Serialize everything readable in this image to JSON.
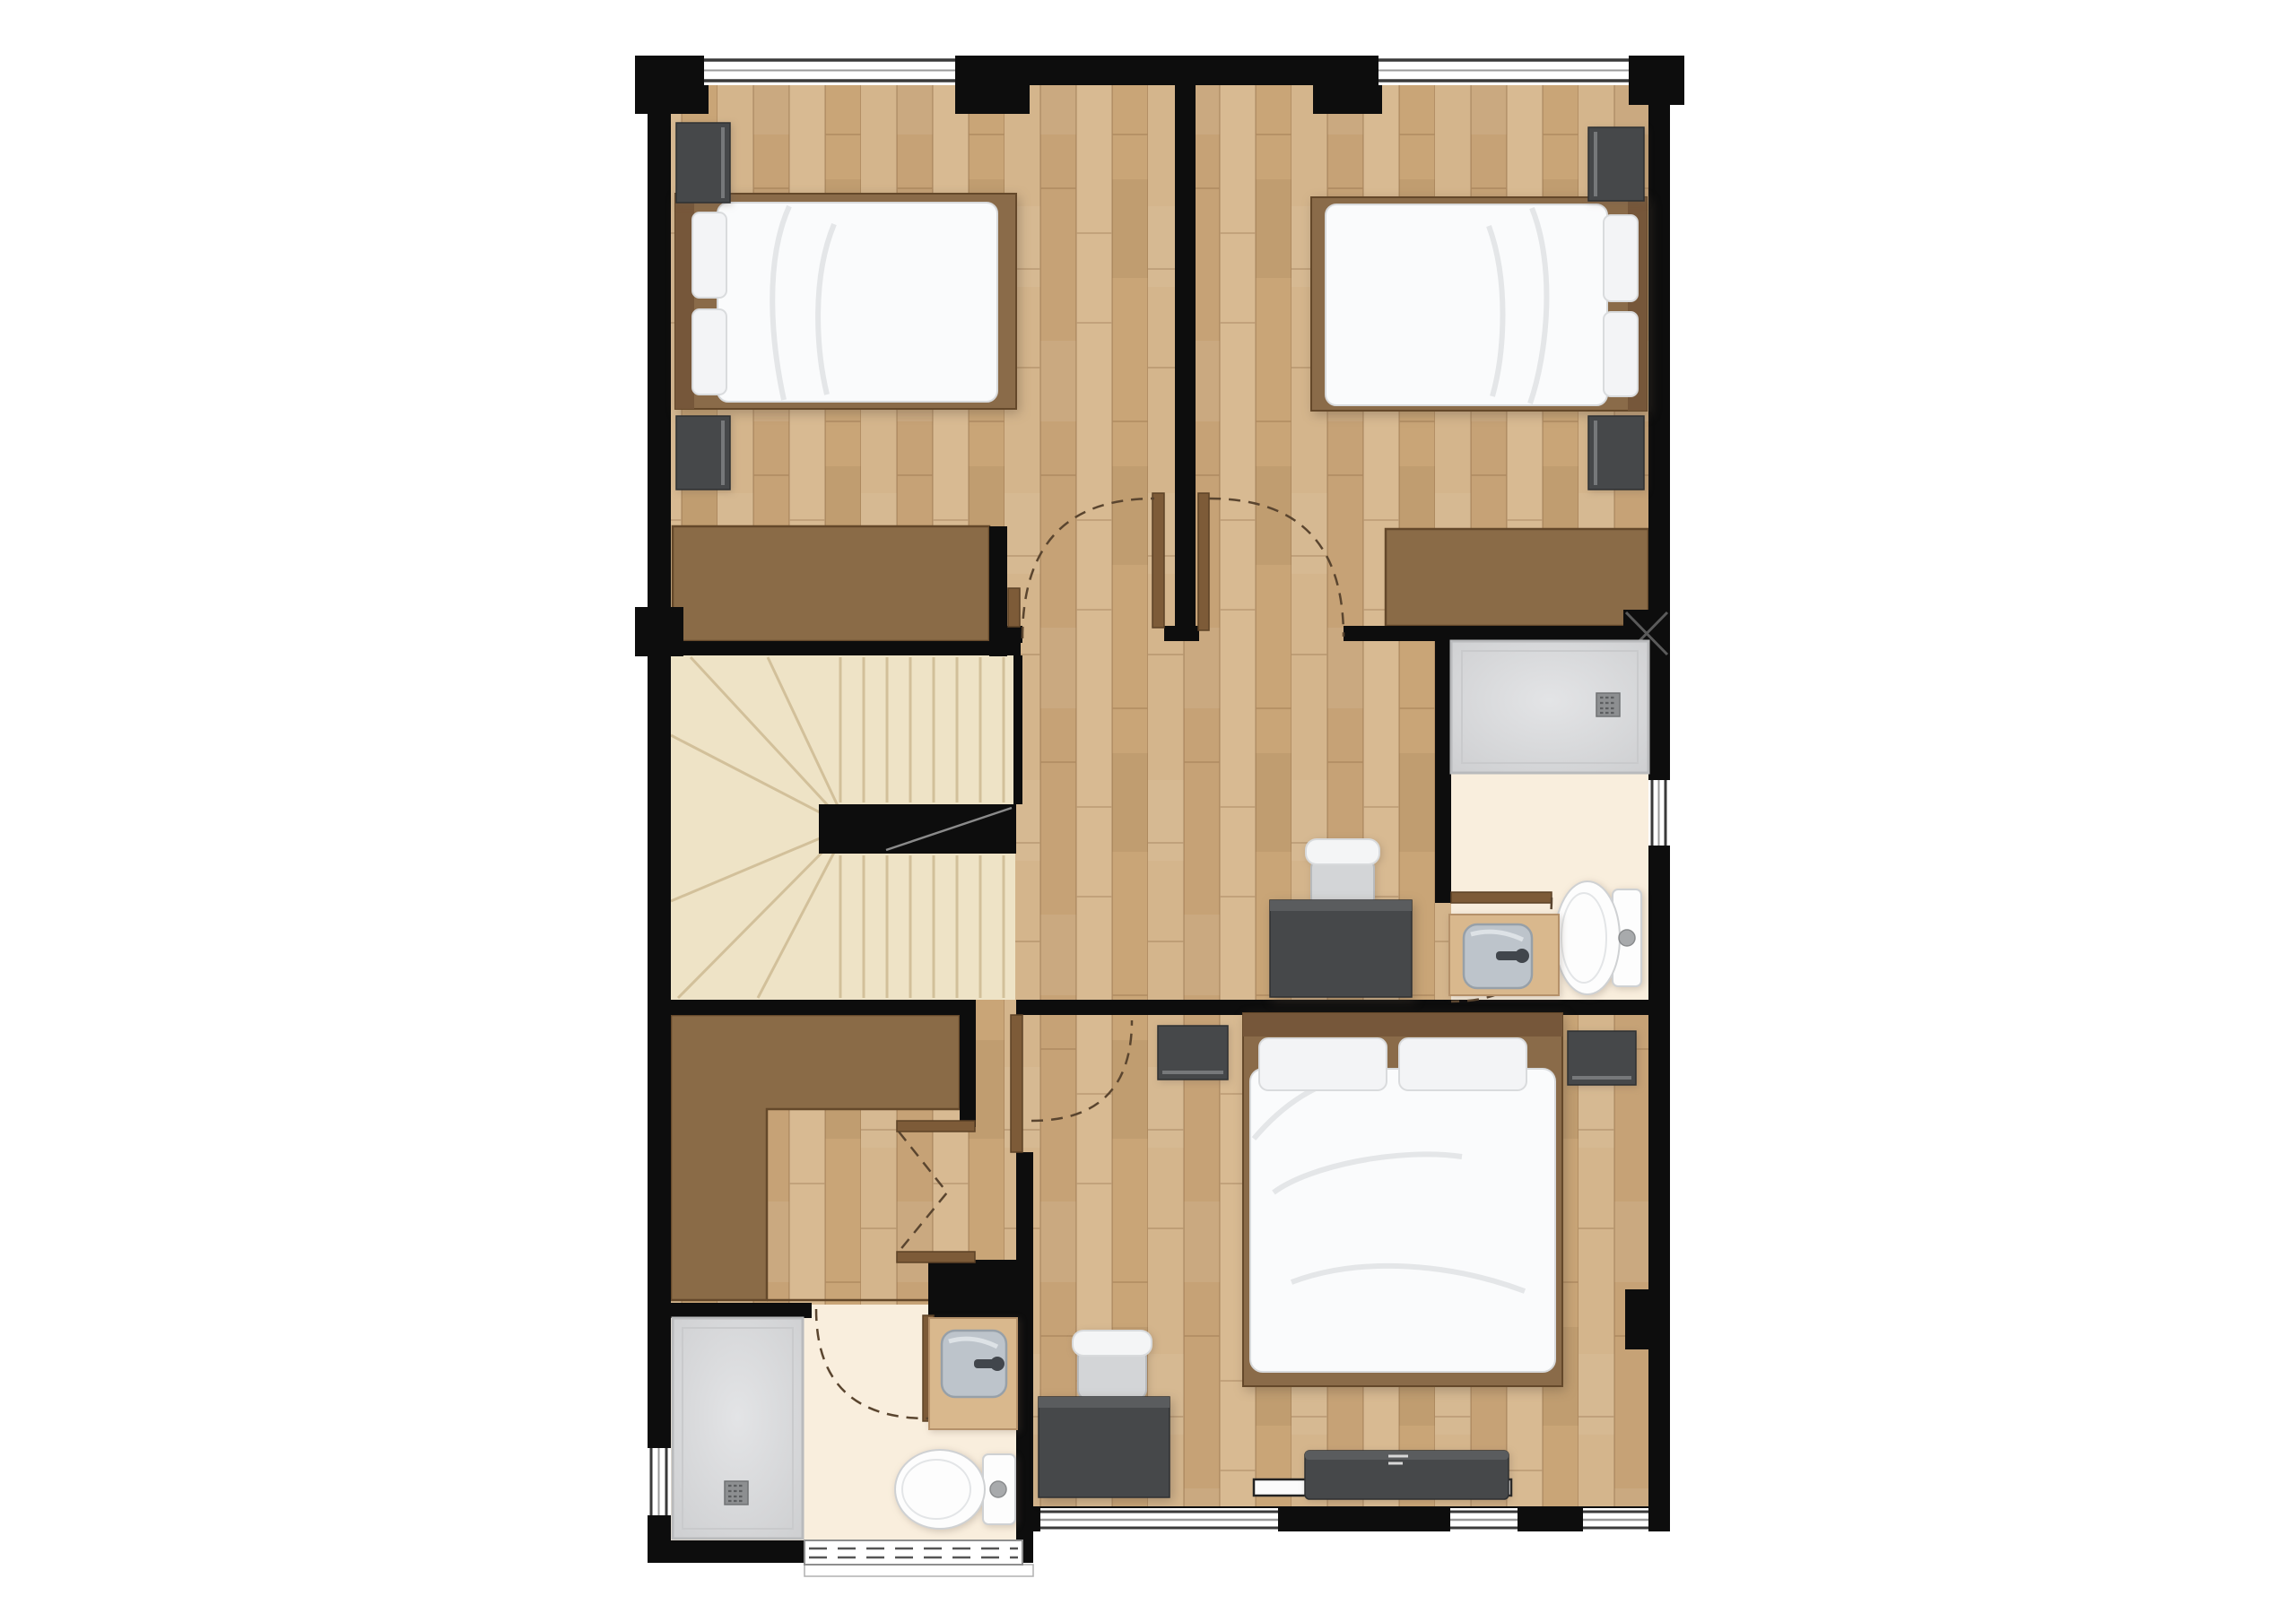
{
  "page": {
    "title": "Upper-floor residential floor plan (top-down 2D render)",
    "view": "orthographic top view",
    "background": "#ffffff"
  },
  "palette": {
    "wall": "#0d0d0d",
    "wood_base": "#cdab7e",
    "stair_floor": "#eee3c6",
    "stair_line": "#d2c09a",
    "bath_floor": "#f9eedd",
    "closet": "#8a6b47",
    "closet_edge": "#64482a",
    "door_panel": "#7d5b38",
    "door_edge": "#5d4226",
    "door_arc": "#5a452f",
    "shower_tray": "#d5d6d8",
    "shower_rim": "#b9babc",
    "shower_inner": "#c9cacc",
    "drain": "#8d8f91",
    "drain_hole": "#5c5e60",
    "fixture_white": "#fdfdfd",
    "fixture_edge": "#cfd1d3",
    "sink_bowl": "#bdc4cb",
    "sink_edge": "#97a0a8",
    "faucet": "#41464c",
    "furniture_dark": "#46484a",
    "furniture_dark_top": "#5a5c5e",
    "furniture_dark_edge": "#2e3032",
    "bed_frame": "#8a6b49",
    "headboard": "#76573a",
    "pillow": "#f3f4f6",
    "pillow_edge": "#d9dbdd",
    "duvet": "#fafbfc",
    "duvet_edge": "#d8dadc",
    "crease": "#e4e6e8",
    "window_fill": "#ffffff",
    "window_frame": "#3a3a3a",
    "window_mid": "#9b9b9b",
    "rail_line": "#8a8a8a",
    "shelf_white": "#fbfbfb",
    "vanity_wood": "#d9b88d",
    "vanity_edge": "#b5916a"
  },
  "rooms": [
    {
      "id": "bedroom-1",
      "position": "top-left",
      "fixtures": [
        "double-bed",
        "nightstand-upper",
        "nightstand-lower",
        "wardrobe",
        "window-top",
        "hinged-door"
      ]
    },
    {
      "id": "bedroom-2",
      "position": "top-right",
      "fixtures": [
        "double-bed",
        "nightstand-upper",
        "nightstand-lower",
        "wardrobe",
        "window-top",
        "hinged-door"
      ]
    },
    {
      "id": "staircase",
      "position": "middle-left",
      "fixtures": [
        "winder-stairs",
        "landing-rail",
        "direction-line"
      ]
    },
    {
      "id": "hallway",
      "position": "center",
      "fixtures": [
        "desk",
        "desk-chair",
        "walk-in-closet",
        "bifold-door"
      ]
    },
    {
      "id": "ensuite-bathroom",
      "position": "middle-right",
      "fixtures": [
        "shower",
        "toilet",
        "sink-vanity",
        "window-right",
        "hinged-door"
      ]
    },
    {
      "id": "master-bedroom",
      "position": "bottom-right",
      "fixtures": [
        "double-bed",
        "nightstand-left",
        "nightstand-right",
        "desk",
        "desk-chair",
        "tv-console",
        "windows-bottom",
        "hinged-door"
      ]
    },
    {
      "id": "bathroom-2",
      "position": "bottom-left",
      "fixtures": [
        "shower",
        "toilet",
        "sink-vanity",
        "window-left",
        "louvre-window-bottom",
        "hinged-door"
      ]
    }
  ]
}
